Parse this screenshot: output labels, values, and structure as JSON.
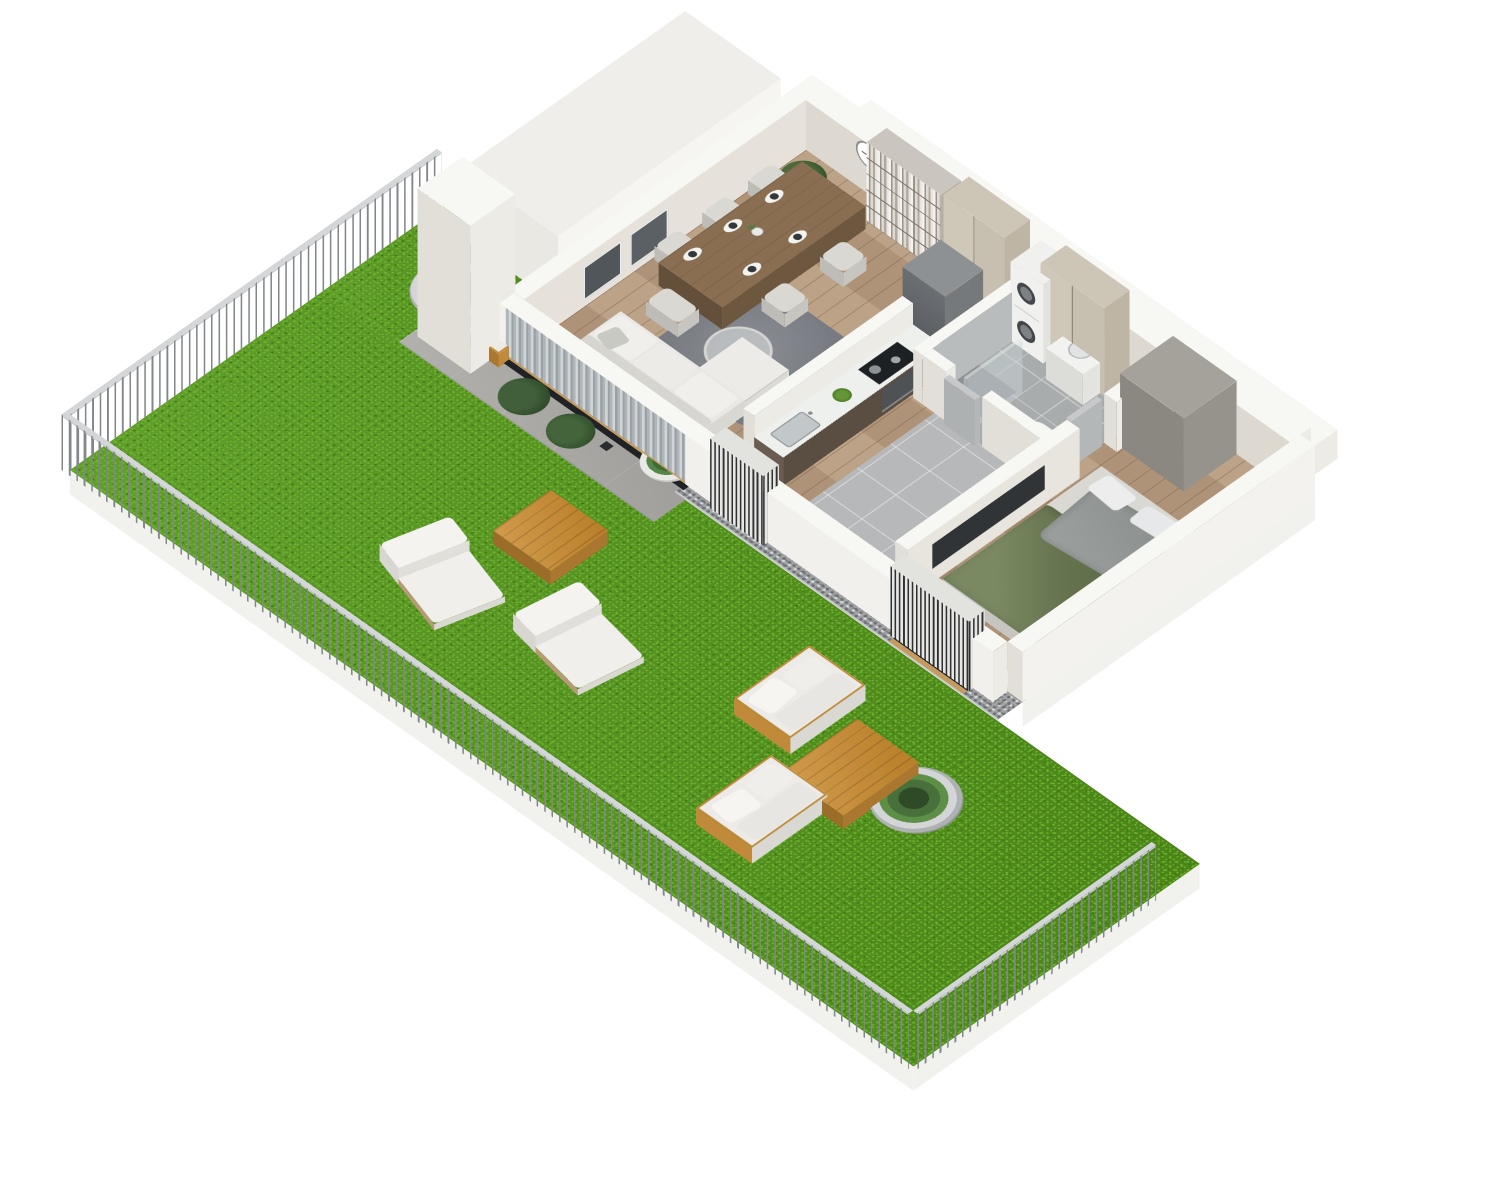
{
  "meta": {
    "type": "3d-isometric-floor-plan-render",
    "aria_label": "3D isometric floor plan of a one-bedroom apartment with a large fenced garden terrace",
    "background": "#ffffff",
    "visible_text": "none"
  },
  "palette": {
    "grass": "#55961c",
    "grass_dark": "#3d7a10",
    "grass_light": "#77bf33",
    "fence": "#82878b",
    "gravel": "#a2a4a6",
    "concrete": "#a9a8a4",
    "wall_top": "#f7f7f4",
    "wall_side": "#edebe6",
    "wall_shade": "#e1dfd8",
    "wood_floor": "#b79b7e",
    "tile_floor": "#b6b8b9",
    "oak_frame": "#c49a5e",
    "counter_wood": "#5a4d42",
    "glass_dark": "#2c3032",
    "curtain": "#aeb5b9",
    "cabinet_beige": "#c7bfb0",
    "sofa_white": "#e9e8e4",
    "rug": "#80848a",
    "duvet_green": "#6f7f60",
    "blanket_grey": "#969a98",
    "outdoor_wood": "#c8892c",
    "appliance_grey": "#75797c"
  },
  "scene": {
    "garden": {
      "surface": "lawn",
      "boundary": "metal picket fence on white curb, three runs",
      "items": [
        {
          "name": "planter-bowl",
          "count": 3
        },
        {
          "name": "sun-lounger",
          "count": 2
        },
        {
          "name": "outdoor-side-table-wood",
          "count": 1
        },
        {
          "name": "outdoor-sofa",
          "count": 2
        },
        {
          "name": "outdoor-coffee-table-wood",
          "count": 1
        },
        {
          "name": "gravel-border",
          "count": 1
        },
        {
          "name": "concrete-terrace",
          "count": 1
        },
        {
          "name": "terrace-bench",
          "count": 1
        },
        {
          "name": "terrace-potted-plants",
          "count": 3
        },
        {
          "name": "lantern",
          "count": 1
        },
        {
          "name": "tall-white-pillar",
          "count": 1
        }
      ]
    },
    "apartment": {
      "rooms": [
        {
          "name": "living-dining-room",
          "floor": "wood planks",
          "furniture": [
            "corner-sofa-white",
            "chaise",
            "round-coffee-table-with-book",
            "area-rug",
            "floor-lamp-globe",
            "dining-table-wood",
            "dining-chairs x6",
            "place-settings x6",
            "vase-with-flowers",
            "bookshelf-full-of-books",
            "wall-clock",
            "framed-window x2",
            "sheer-curtains",
            "potted-plant"
          ]
        },
        {
          "name": "kitchen",
          "floor": "wood planks",
          "furniture": [
            "counter-dark-wood",
            "sink-with-faucet",
            "green-bowl",
            "cooktop-with-pots",
            "built-in-oven",
            "fridge-grey"
          ]
        },
        {
          "name": "hallway",
          "floor": "grey tile",
          "furniture": [
            "tall-wardrobe-cabinet x2",
            "entry-door-oak"
          ]
        },
        {
          "name": "bathroom",
          "floor": "grey tile",
          "furniture": [
            "washer-dryer-stack",
            "toilet",
            "vanity-with-plant",
            "shower-glass-panel",
            "interior-door"
          ]
        },
        {
          "name": "bedroom",
          "floor": "wood planks",
          "furniture": [
            "double-bed",
            "green-duvet",
            "grey-blanket",
            "pillows x2",
            "wardrobe-grey",
            "tv-panel",
            "window-with-louvres"
          ]
        }
      ],
      "structure": [
        "white cut-away walls",
        "tall white wall wedge at north corner",
        "stepped outer ledge on north-east side",
        "window wall with oak frames and louvre screens"
      ]
    }
  }
}
